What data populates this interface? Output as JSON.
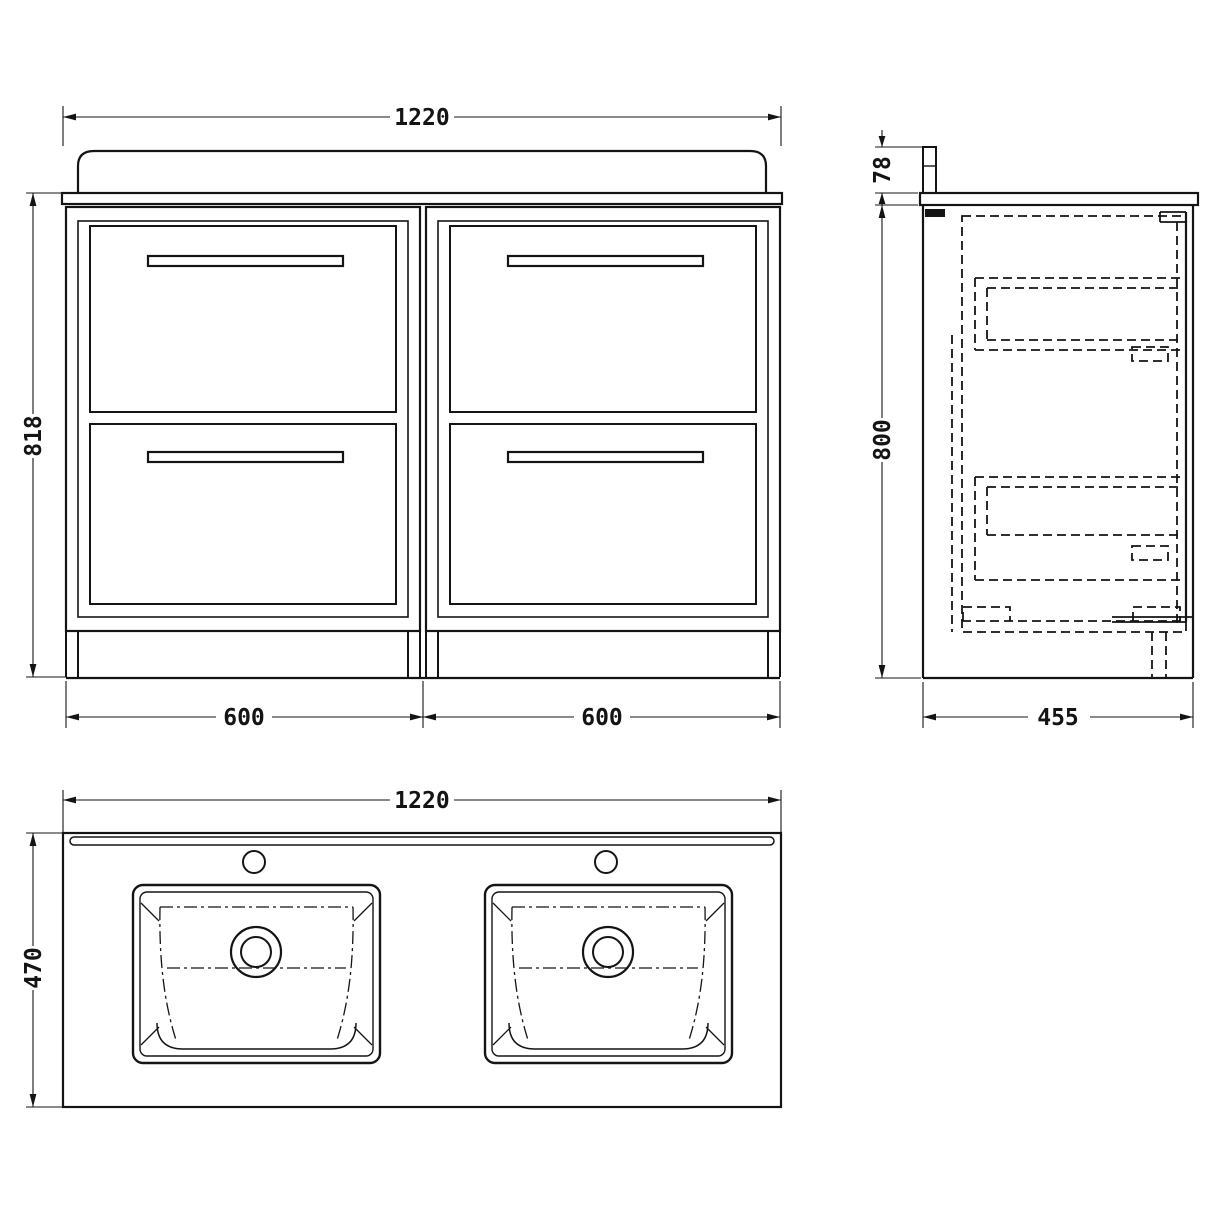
{
  "drawing": {
    "background": "#ffffff",
    "line_color": "#141414",
    "front_view": {
      "width_label": "1220",
      "height_label": "818",
      "left_unit_width_label": "600",
      "right_unit_width_label": "600"
    },
    "side_view": {
      "upstand_height_label": "78",
      "height_label": "800",
      "depth_label": "455"
    },
    "plan_view": {
      "width_label": "1220",
      "depth_label": "470"
    }
  }
}
